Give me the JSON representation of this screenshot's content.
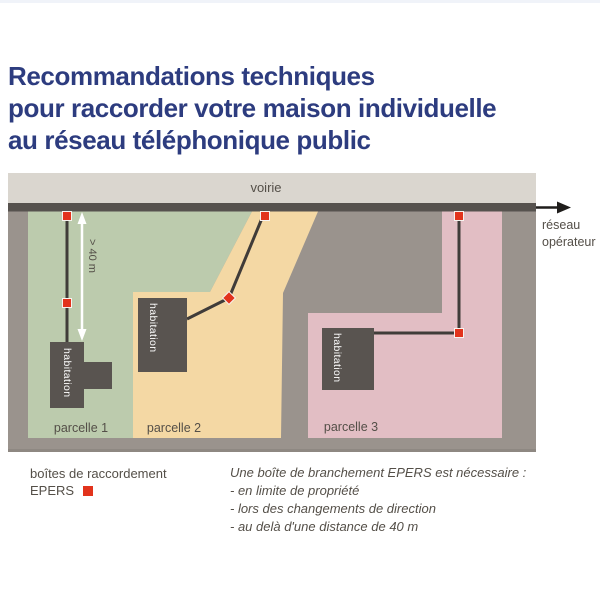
{
  "page": {
    "title": "Recommandations techniques\npour raccorder votre maison individuelle\nau réseau téléphonique public"
  },
  "diagram": {
    "road_label": "voirie",
    "network_label_line1": "réseau",
    "network_label_line2": "opérateur",
    "distance_label": "> 40 m",
    "parcels": [
      {
        "label": "parcelle 1",
        "house_label": "habitation",
        "color": "#bccbad"
      },
      {
        "label": "parcelle 2",
        "house_label": "habitation",
        "color": "#f4d8a4"
      },
      {
        "label": "parcelle 3",
        "house_label": "habitation",
        "color": "#e2bec4"
      }
    ],
    "colors": {
      "frame_gray": "#9a938d",
      "road_band": "#dad6cf",
      "road_line": "#56524e",
      "house": "#595450",
      "cable": "#403c39",
      "epers_red": "#e2331c",
      "label_text": "#544f48",
      "title_blue": "#2d3c7f",
      "dimension_arrow": "#ffffff"
    }
  },
  "legend": {
    "marker_label_line1": "boîtes de raccordement",
    "marker_label_line2": "EPERS",
    "note_title": "Une boîte de branchement EPERS est nécessaire :",
    "note_items": [
      "- en limite de propriété",
      "- lors des changements de direction",
      "- au delà d'une distance de 40 m"
    ]
  }
}
